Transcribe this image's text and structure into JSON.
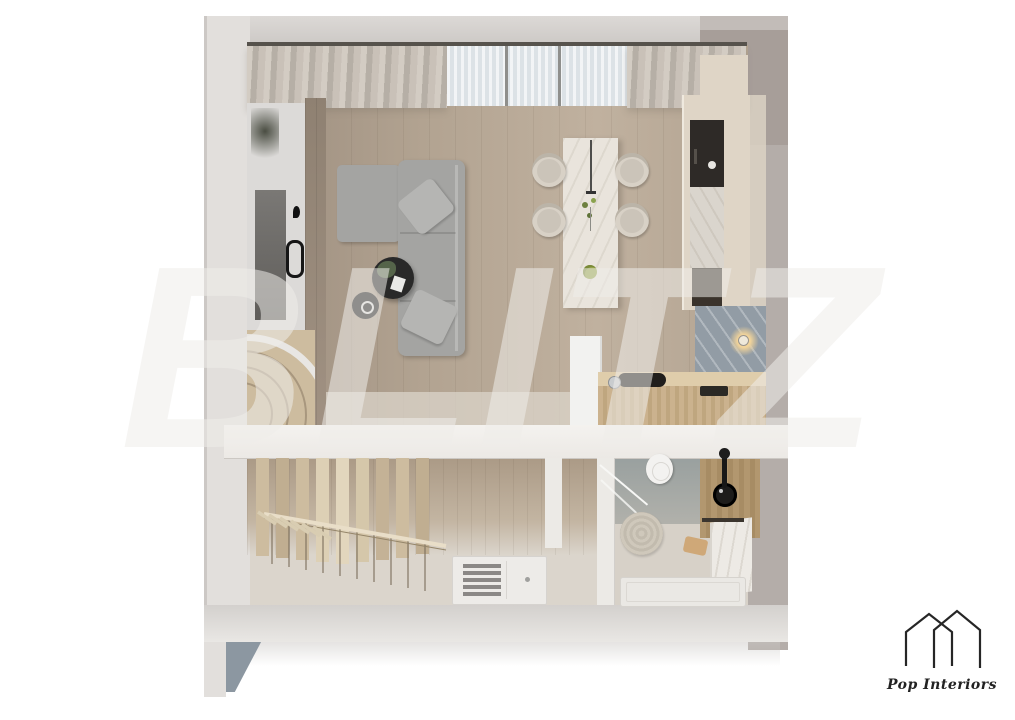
{
  "watermark": {
    "text": "BLITZ"
  },
  "brand": {
    "name": "Pop Interiors",
    "icon": "double-house-outline-icon"
  },
  "scene": {
    "type": "3d-floor-plan-top-view-render",
    "levels": [
      {
        "name": "main-level",
        "rooms": [
          "entry",
          "living-room",
          "dining-area",
          "kitchen"
        ]
      },
      {
        "name": "lower-level",
        "rooms": [
          "staircase-hall",
          "entrance",
          "bathroom"
        ]
      }
    ],
    "objects": [
      "curtains",
      "sheer-window",
      "entry-door-with-mirror",
      "l-shaped-sofa",
      "throw-pillows",
      "coffee-table",
      "side-table",
      "plant",
      "dining-island",
      "pendant-light",
      "dining-chairs-x4",
      "kitchen-tall-unit",
      "oven-niche",
      "marble-backsplash",
      "wall-lamp",
      "kitchen-counter",
      "cooktop",
      "staircase",
      "louvered-front-door",
      "toilet",
      "round-rug",
      "black-vessel-sink",
      "faucet",
      "shower-tray",
      "towel",
      "marble-wall"
    ]
  },
  "colors": {
    "page_bg": "#ffffff",
    "wall": "#e2dfdc",
    "wall_right": "#b4ada9",
    "backdrop": "#a79e99",
    "floor_wood": "#b2a391",
    "floor_wood_dark": "#9c8d7e",
    "floor_lower": "#dbd5cc",
    "slab": "#ece9e5",
    "curtain": "#c9c1b8",
    "sheer": "#e6eaed",
    "sofa": "#a4a4a2",
    "pillow": "#b5b5b3",
    "table_dark": "#292929",
    "island": "#e9e4dc",
    "chair": "#d8d1c6",
    "cream": "#dfd5c6",
    "niche": "#2e2a27",
    "backsplash": "#929ca5",
    "glow": "#f2d49a",
    "counter_wood": "#c6ad8a",
    "stair_wood": "#cdbc9f",
    "wedge": "#8c97a1",
    "ink": "#222222",
    "watermark": "rgba(238,236,233,0.55)"
  }
}
